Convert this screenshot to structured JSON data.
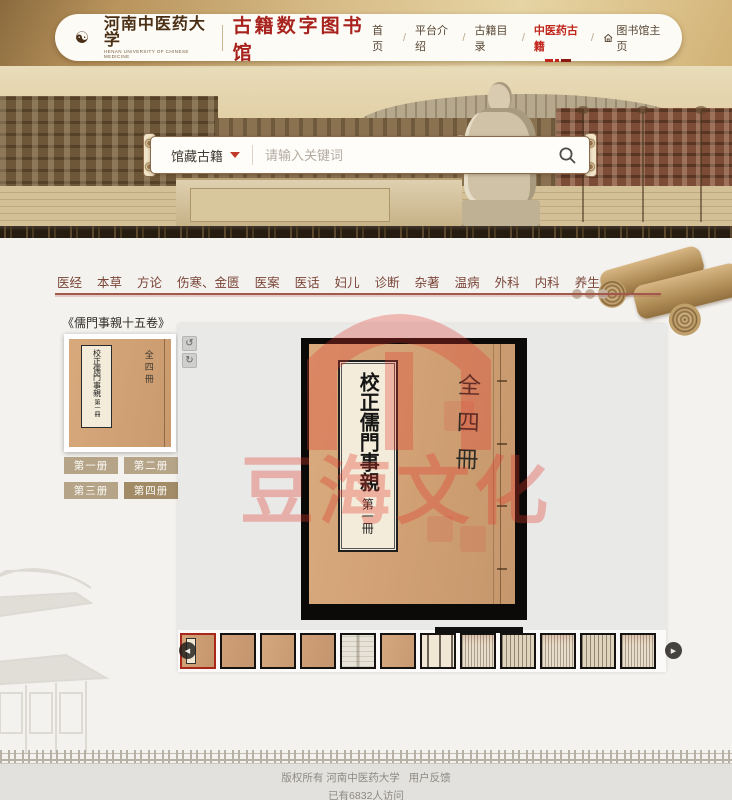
{
  "header": {
    "university_name": "河南中医药大学",
    "university_name_en": "HENAN UNIVERSITY OF CHINESE MEDICINE",
    "site_title": "古籍数字图书馆",
    "nav": [
      {
        "label": "首 页"
      },
      {
        "label": "平台介绍"
      },
      {
        "label": "古籍目录"
      },
      {
        "label": "中医药古籍"
      },
      {
        "label": "图书馆主页"
      }
    ],
    "nav_separator": "/"
  },
  "search": {
    "category": "馆藏古籍",
    "placeholder": "请输入关键词"
  },
  "tabs": [
    "医经",
    "本草",
    "方论",
    "伤寒、金匮",
    "医案",
    "医话",
    "妇儿",
    "诊断",
    "杂著",
    "温病",
    "外科",
    "内科",
    "养生"
  ],
  "sidebar": {
    "book_title": "《儒門事親十五卷》",
    "volumes": [
      "第一册",
      "第二册",
      "第三册",
      "第四册"
    ]
  },
  "viewer": {
    "rotate_left": "↺",
    "rotate_right": "↻",
    "cover_title": "校正儒門事親",
    "cover_volume": "第一冊",
    "cover_note": "全四冊",
    "watermark_text": "豆海文化"
  },
  "thumbnails": {
    "count": 12,
    "selected_index": 0,
    "prev": "◀",
    "next": "▶"
  },
  "footer": {
    "copyright": "版权所有 河南中医药大学",
    "feedback": "用户反馈",
    "visitors": "已有6832人访问"
  },
  "icons": {
    "logo": "taiji-seal-icon",
    "logo_glyph": "☯",
    "dropdown": "chevron-down-icon",
    "search": "magnifier-icon",
    "home": "house-icon"
  },
  "colors": {
    "accent_red": "#b5342a",
    "active_nav_red": "#c0261c",
    "tab_text": "#7a4638",
    "tab_line": "#a2594c",
    "button_tan": "#b5a488",
    "button_tan_active": "#a28c68",
    "header_gold": "#c9a76a",
    "viewer_bg": "#e9e9e8",
    "watermark_red": "#e2372a",
    "cover_tan": "#d2a276"
  }
}
